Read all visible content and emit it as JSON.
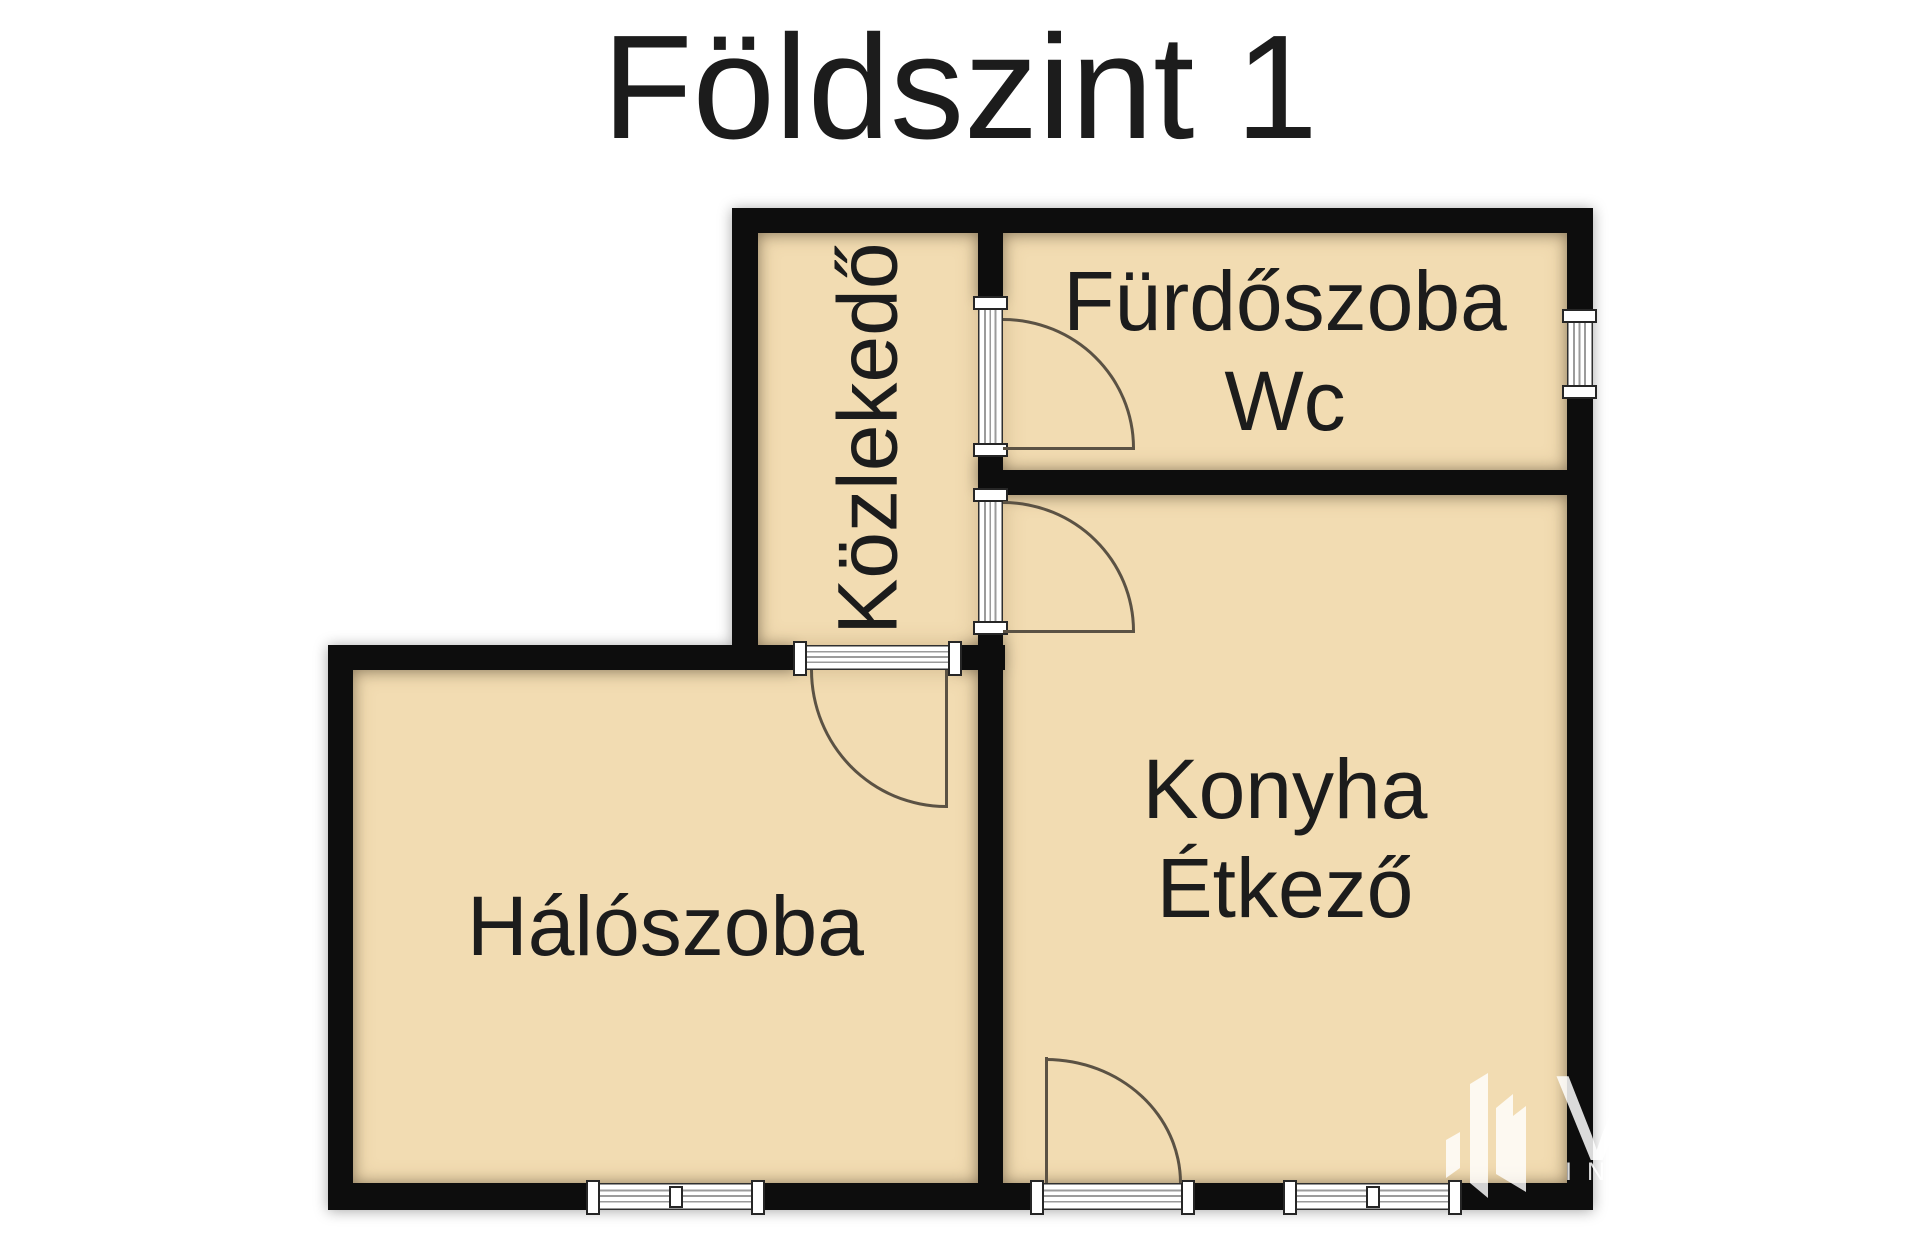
{
  "title": "Földszint 1",
  "rooms": {
    "hallway": {
      "label": "Közlekedő"
    },
    "bathroom": {
      "label_line1": "Fürdőszoba",
      "label_line2": "Wc"
    },
    "kitchen": {
      "label_line1": "Konyha",
      "label_line2": "Étkező"
    },
    "bedroom": {
      "label": "Hálószoba"
    }
  },
  "watermark": {
    "icon": "building-logo-icon",
    "letter": "V",
    "caption": "IN"
  },
  "colors": {
    "wall": "#0d0d0d",
    "room_fill": "#f2dcb2",
    "door_arc": "#5b5244",
    "text": "#1c1c1c",
    "background": "#ffffff"
  }
}
